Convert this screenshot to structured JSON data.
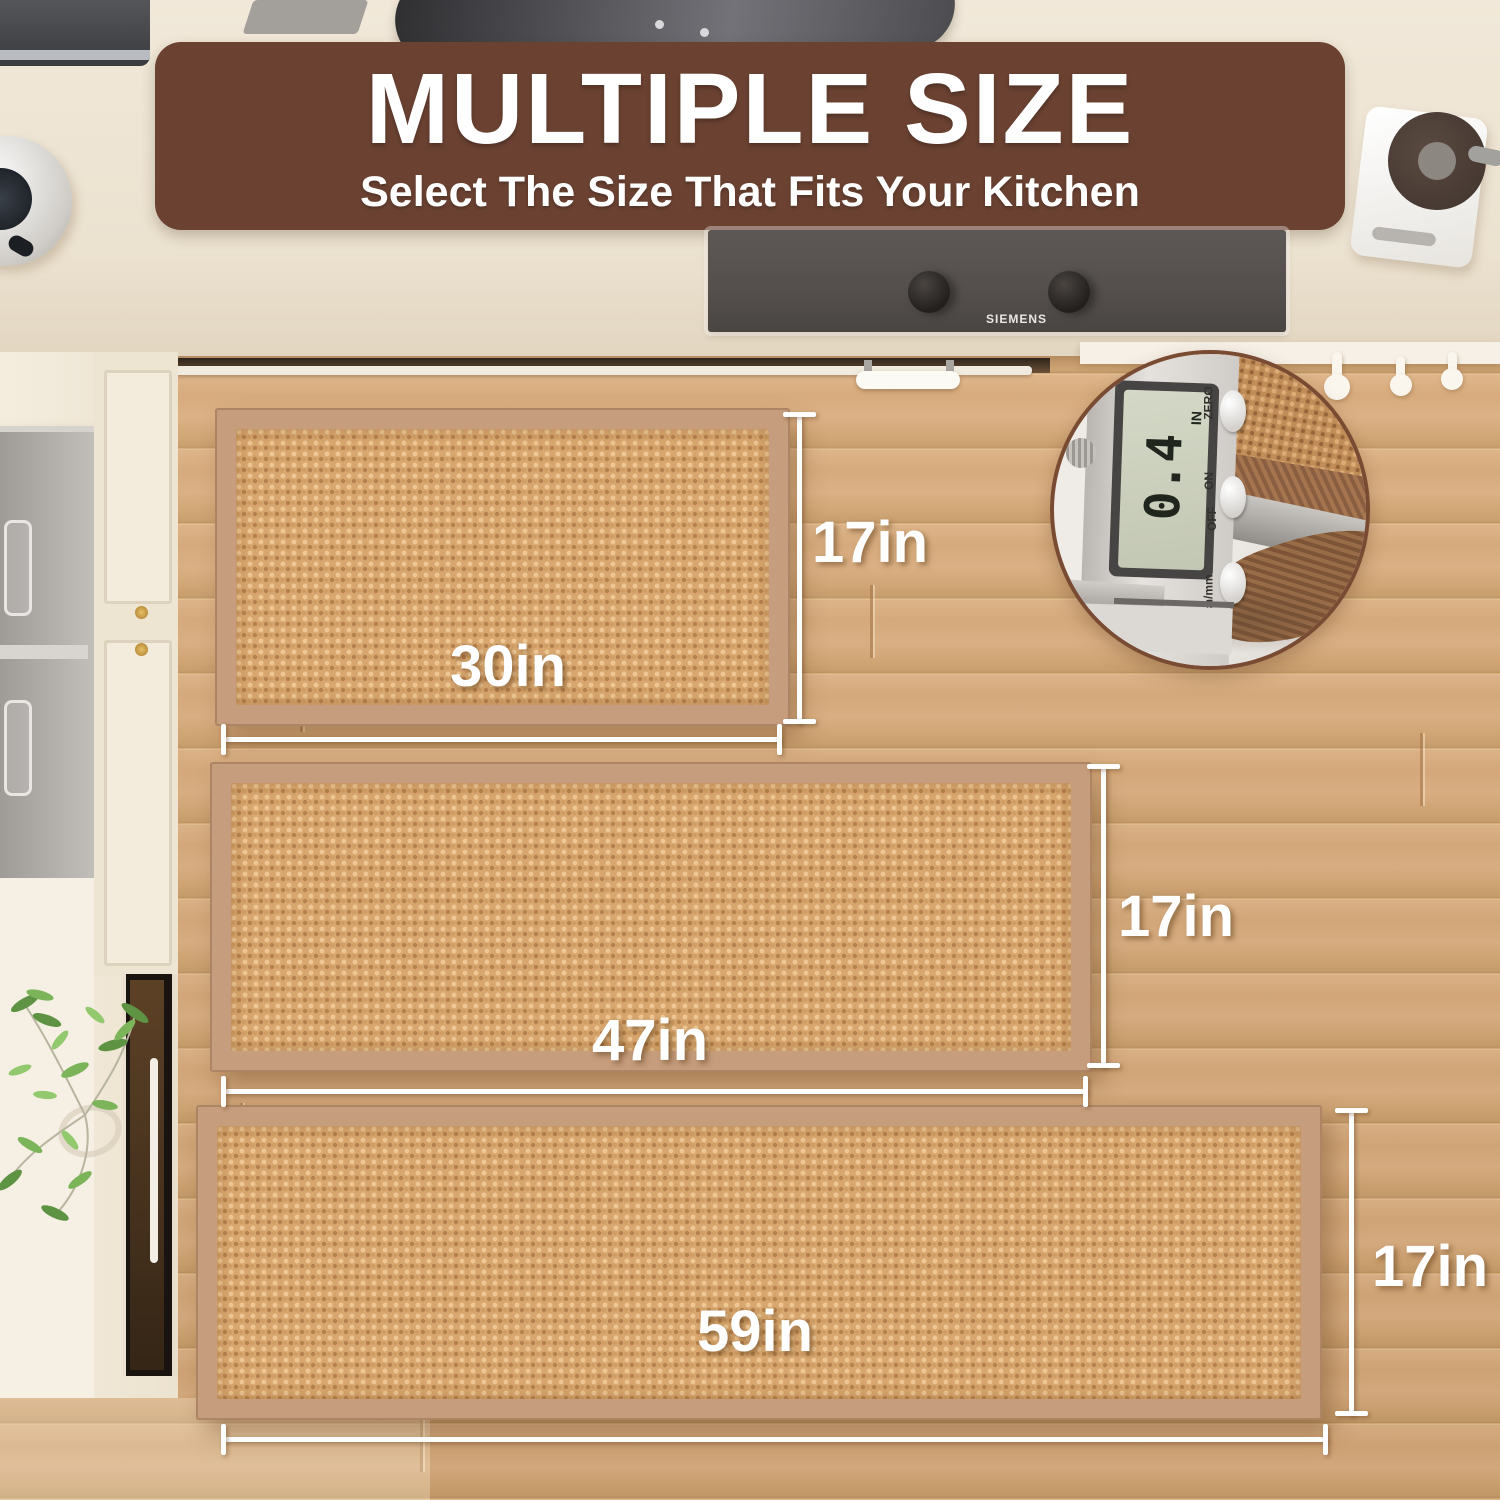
{
  "banner": {
    "title": "MULTIPLE SIZE",
    "subtitle": "Select The Size That Fits Your Kitchen"
  },
  "rugs": [
    {
      "id": "rug-30x17",
      "width_label": "30in",
      "height_label": "17in"
    },
    {
      "id": "rug-47x17",
      "width_label": "47in",
      "height_label": "17in"
    },
    {
      "id": "rug-59x17",
      "width_label": "59in",
      "height_label": "17in"
    }
  ],
  "thickness_inset": {
    "display_value": "0.4",
    "display_unit": "IN",
    "zero_label": "ZERO",
    "on_label": "ON",
    "off_label": "OFF",
    "mode_label": "inch/mm"
  },
  "stove": {
    "brand": "SIEMENS"
  },
  "colors": {
    "banner_bg": "#6b4232",
    "text": "#ffffff",
    "rug_border": "#c69d7d",
    "rug_weave": "#d8a76f",
    "floor_base": "#dcb07f",
    "counter": "#f0e7d7",
    "stove_panel": "#56514d"
  }
}
